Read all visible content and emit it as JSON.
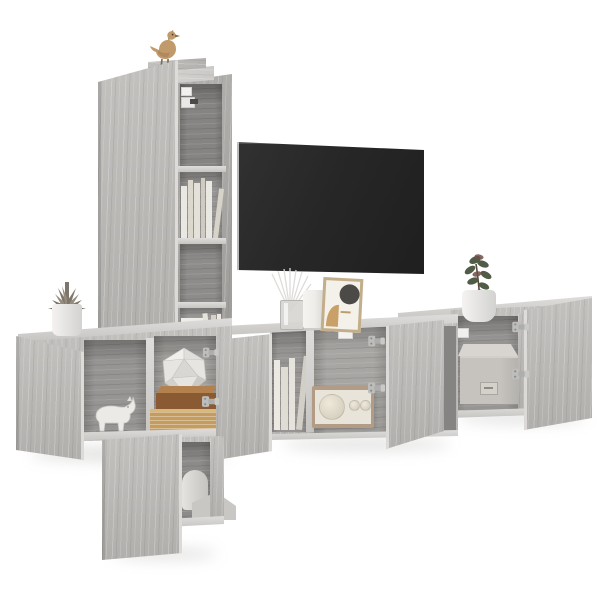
{
  "scene": {
    "description": "Product photo: 5-piece grey sonoma oak wall-mounted TV entertainment unit with open doors, a flat-screen TV and decorative items on a white wall",
    "background": "#ffffff"
  },
  "palette": {
    "wall": "#ffffff",
    "wood": "#bcbab7",
    "wood-dark": "#a7a5a2",
    "wood-light": "#d6d4d1",
    "wood-edge": "#e3e1de",
    "interior": "#979593",
    "interior-dark": "#868482",
    "shelf-edge": "#d0cecb",
    "tv-screen": "#272727",
    "tv-edge": "#c9c9c9",
    "bird": "#c09a6a",
    "pot": "#eeedeb",
    "succulent": "#7e766a",
    "plant-green": "#515c46",
    "plant-red": "#6e5047",
    "rhino": "#eceae7",
    "poly": "#e6e5e1",
    "book-brown": "#8a5a32",
    "book-brown-top": "#b3814e",
    "book-tan": "#c49c60",
    "book-white": "#eae8e2",
    "radio-frame": "#b39c86",
    "radio-face": "#e9e4d9",
    "box": "#c6c3be",
    "box-top": "#d8d5d0",
    "glass": "#d8d7d3",
    "vase": "#efede9",
    "frame-wood": "#c2ae8a",
    "art-dark": "#4c4a46",
    "art-tan": "#c9a168",
    "hinge": "#aeaeac"
  },
  "objects": {
    "tv": "wall-mounted flat-screen TV, switched off",
    "tall_cabinet": "tall wall cabinet with long door and open shelf column holding books",
    "bird_figurine": "gold bird figurine on top of the tall cabinet",
    "left_cabinet": "wall cabinet with open door, white rhino figurine, stacked books and a geometric ornament",
    "succulent": "potted succulent on the left cabinet",
    "middle_cabinet": "TV wall cabinet with two open doors, upright books and a retro radio",
    "diffuser": "reed diffuser with white sticks",
    "vase": "white cylindrical vase",
    "picture_frame": "leaning picture frame with abstract circle art",
    "right_cabinet": "wall cabinet with open doors and a grey storage box",
    "plant": "green potted plant on the right cabinet",
    "storage_box": "grey storage box with label holder",
    "bottom_cabinet": "lower wall cabinet with open door, round vase and riser block",
    "rhino_figurine": "white rhino figurine",
    "radio": "beige retro radio with speaker and two knobs",
    "books_tall": "white and cream books on the open shelves",
    "hinges": "metal cabinet hinges"
  }
}
